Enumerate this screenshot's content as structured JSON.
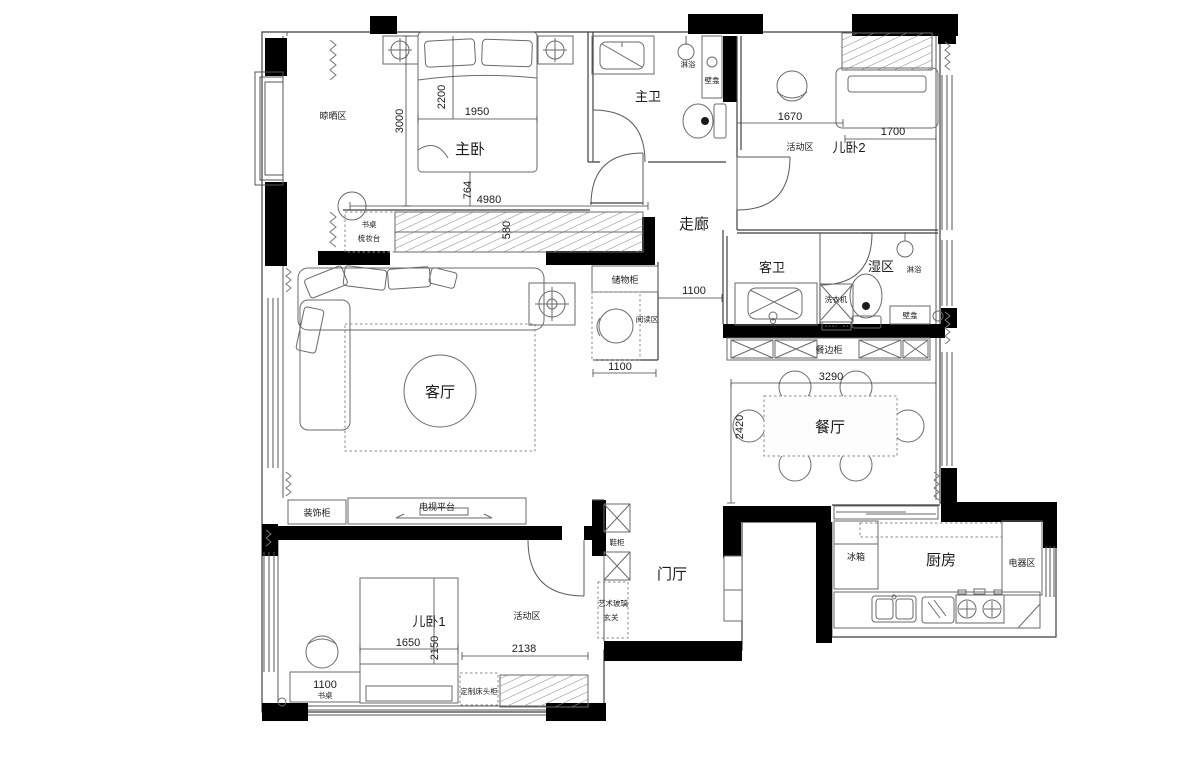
{
  "plan": {
    "rooms": {
      "drying_area": "晾晒区",
      "master_bedroom": "主卧",
      "master_bath": "主卫",
      "kid_bedroom_2": "儿卧2",
      "corridor": "走廊",
      "guest_bath": "客卫",
      "wet_zone": "湿区",
      "living_room": "客厅",
      "dining_room": "餐厅",
      "foyer": "门厅",
      "kitchen": "厨房",
      "kid_bedroom_1": "儿卧1"
    },
    "zones": {
      "activity_area_2": "活动区",
      "activity_area_1": "活动区",
      "reading_nook": "阅读区",
      "entry": "玄关"
    },
    "fixtures": {
      "shower_master": "淋浴",
      "shower_wet": "淋浴",
      "niche_master": "壁龛",
      "niche_wet": "壁龛",
      "washing_machine": "洗衣机",
      "storage_cabinet": "储物柜",
      "sideboard": "餐边柜",
      "desk_vanity_line1": "书桌",
      "desk_vanity_line2": "梳妆台",
      "deco_cabinet": "装饰柜",
      "tv_platform": "电视平台",
      "shoe_cabinet": "鞋柜",
      "art_glass": "艺术玻璃",
      "fridge": "冰箱",
      "appliance_area": "电器区",
      "desk": "书桌",
      "custom_bedside": "定制床头柜"
    },
    "dimensions": {
      "master_height": "3000",
      "master_bed_len": "2200",
      "master_bed_w": "1950",
      "offset_764": "764",
      "wardrobe_len": "4980",
      "wardrobe_depth": "580",
      "kid2_width": "1670",
      "kid2_bed": "1700",
      "corridor_w": "1100",
      "reading_w": "1100",
      "dining_w": "3290",
      "dining_h": "2420",
      "kid1_bed_w": "1650",
      "kid1_bed_len": "2150",
      "activity_w": "2138",
      "desk_w": "1100"
    }
  }
}
